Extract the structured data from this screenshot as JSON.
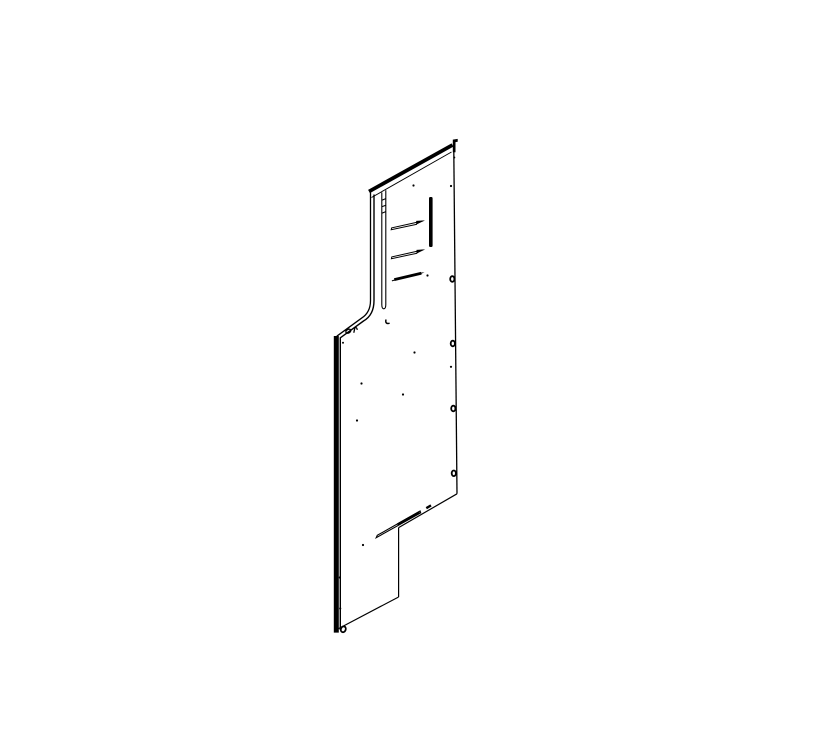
{
  "meta": {
    "description": "Isometric CAD line drawing of a sheet-metal side panel on a blank white background",
    "background_color": "#ffffff",
    "line_color": "#000000"
  },
  "drawing": {
    "viewbox": "0 0 840 750",
    "width": 840,
    "height": 750,
    "stroke_paths": [
      {
        "name": "top-edge-outer",
        "d": "M369,191.5 L452.5,145",
        "w": 3.8
      },
      {
        "name": "top-edge-inner",
        "d": "M371.5,197.5 L451.5,152",
        "w": 1.0
      },
      {
        "name": "left-edge-outer",
        "d": "M370.5,192.5 L370.5,300.5 Q370.5,312.5 361.5,318.2 L336.8,336.2",
        "w": 1.3
      },
      {
        "name": "left-edge-inner",
        "d": "M374,194.5 L374,300.5 Q374,315 363.5,321 L340.3,337.8 L340.3,630",
        "w": 1.4
      },
      {
        "name": "left-bar-edge",
        "d": "M336.3,336 L336.3,632.6",
        "w": 5.0
      },
      {
        "name": "right-edge",
        "d": "M453.8,150.5 L457,493.8",
        "w": 1.3
      },
      {
        "name": "step-edge",
        "d": "M457,493.8 L398.6,527.6",
        "w": 1.2
      },
      {
        "name": "step-edge-notch",
        "d": "M426.3,508.2 L431,505.4",
        "w": 2.4
      },
      {
        "name": "lower-right-edge",
        "d": "M398.6,527.6 L398.6,597",
        "w": 1.2
      },
      {
        "name": "bottom-edge",
        "d": "M398.6,597 L338.5,628.6",
        "w": 1.2
      },
      {
        "name": "flange-channel",
        "d": "M381.8,192.5 L381.8,304.5 Q381.8,308.8 383.8,308.8 Q385.8,308.8 385.8,304.5 L385.8,190.3",
        "w": 1.1
      },
      {
        "name": "channel-tick-1",
        "d": "M381.8,200.2 L385.8,198.6",
        "w": 1.1
      },
      {
        "name": "channel-tick-2",
        "d": "M381.8,206.8 L385.8,205.2",
        "w": 1.1
      },
      {
        "name": "channel-tick-3",
        "d": "M381.8,213.2 L385.8,211.6",
        "w": 1.1
      },
      {
        "name": "bend-relief-hook",
        "d": "M386,319.5 C385.2,322.8 386.6,324.2 389.6,323.2",
        "w": 1.5
      },
      {
        "name": "shoulder-keyhole-mark",
        "d": "M353.8,332.8 L354.9,327.6 Q356.9,327.1 357.3,329.9",
        "w": 1.3
      },
      {
        "name": "louver-1-body",
        "d": "M423.2,220.9 L391.6,227.9 L391.2,229.7 L417,224.2",
        "w": 1.0
      },
      {
        "name": "louver-2-body",
        "d": "M423.2,249.9 L391.8,256.9 L391.4,258.7 L417.2,253.2",
        "w": 1.0
      },
      {
        "name": "louver-3-body",
        "d": "M394.3,279.6 L421.3,273.3",
        "w": 2.8
      },
      {
        "name": "louver-3-left-tip",
        "d": "M391.9,280.9 L397.5,279.1",
        "w": 1.0
      },
      {
        "name": "bottom-slot-overlay",
        "d": "M397.5,524.6 L419.6,512.2",
        "w": 2.6
      }
    ],
    "outlined_shapes": [
      {
        "name": "bottom-slot-outline",
        "d": "M420.1,511 L377.3,535.3 L376.2,537.7 L420.7,512.9 Z",
        "w": 1.1
      }
    ],
    "filled_shapes": [
      {
        "name": "corner-tab",
        "d": "M452.8,152.3 L452.8,139.6 L457.7,138.9 L457.7,141.8 L455.5,142.1 L455.5,152.3 Z"
      },
      {
        "name": "vertical-slot",
        "d": "M429,198.5 Q429,197 430.2,197 L431.4,197 Q432.6,197 432.6,198.5 L432.6,245.5 Q432.6,247 431.4,247 L430.2,247 Q429,247 429,245.5 Z"
      },
      {
        "name": "louver-1-tip",
        "d": "M416.2,224.6 L425,220.4 L416.2,220.9 Z"
      },
      {
        "name": "louver-2-tip",
        "d": "M416.5,253.6 L425.2,249.4 L416.5,249.9 Z"
      },
      {
        "name": "louver-3-tip",
        "d": "M419.3,274.7 L424.5,272.2 L419.5,272.7 Z"
      }
    ],
    "oval_holes": [
      {
        "name": "right-fold-hole-1",
        "cx": 452.3,
        "cy": 279.0,
        "rx": 2.1,
        "ry": 2.8,
        "rot": 0,
        "w": 1.8
      },
      {
        "name": "right-fold-hole-2",
        "cx": 452.8,
        "cy": 343.5,
        "rx": 2.1,
        "ry": 2.8,
        "rot": 0,
        "w": 1.8
      },
      {
        "name": "right-fold-hole-3",
        "cx": 453.3,
        "cy": 408.5,
        "rx": 2.1,
        "ry": 2.8,
        "rot": 0,
        "w": 1.8
      },
      {
        "name": "right-fold-hole-4",
        "cx": 453.8,
        "cy": 473.3,
        "rx": 2.1,
        "ry": 2.8,
        "rot": 0,
        "w": 1.8
      },
      {
        "name": "shoulder-hole",
        "cx": 348.3,
        "cy": 331.2,
        "rx": 2.6,
        "ry": 1.8,
        "rot": -28,
        "w": 1.4
      },
      {
        "name": "bottom-left-hole",
        "cx": 343.3,
        "cy": 629.3,
        "rx": 2.4,
        "ry": 3.0,
        "rot": 22,
        "w": 1.8
      }
    ],
    "dot_holes": [
      {
        "name": "pilot-hole-1",
        "cx": 413.5,
        "cy": 185.5,
        "r": 1.1
      },
      {
        "name": "pilot-hole-2",
        "cx": 451.0,
        "cy": 186.0,
        "r": 1.1
      },
      {
        "name": "pilot-hole-3",
        "cx": 454.3,
        "cy": 157.5,
        "r": 1.0
      },
      {
        "name": "pilot-hole-4",
        "cx": 427.5,
        "cy": 275.5,
        "r": 1.1
      },
      {
        "name": "pilot-hole-5",
        "cx": 343.0,
        "cy": 342.8,
        "r": 1.0
      },
      {
        "name": "pilot-hole-6",
        "cx": 414.5,
        "cy": 352.5,
        "r": 1.1
      },
      {
        "name": "pilot-hole-7",
        "cx": 451.0,
        "cy": 366.8,
        "r": 1.1
      },
      {
        "name": "pilot-hole-8",
        "cx": 361.5,
        "cy": 383.5,
        "r": 1.1
      },
      {
        "name": "pilot-hole-9",
        "cx": 403.0,
        "cy": 394.5,
        "r": 1.1
      },
      {
        "name": "pilot-hole-10",
        "cx": 357.0,
        "cy": 420.5,
        "r": 1.1
      },
      {
        "name": "pilot-hole-11",
        "cx": 363.0,
        "cy": 545.0,
        "r": 1.1
      },
      {
        "name": "pilot-hole-12",
        "cx": 339.8,
        "cy": 577.5,
        "r": 1.1
      },
      {
        "name": "pilot-hole-13",
        "cx": 340.2,
        "cy": 608.5,
        "r": 1.1
      }
    ]
  }
}
